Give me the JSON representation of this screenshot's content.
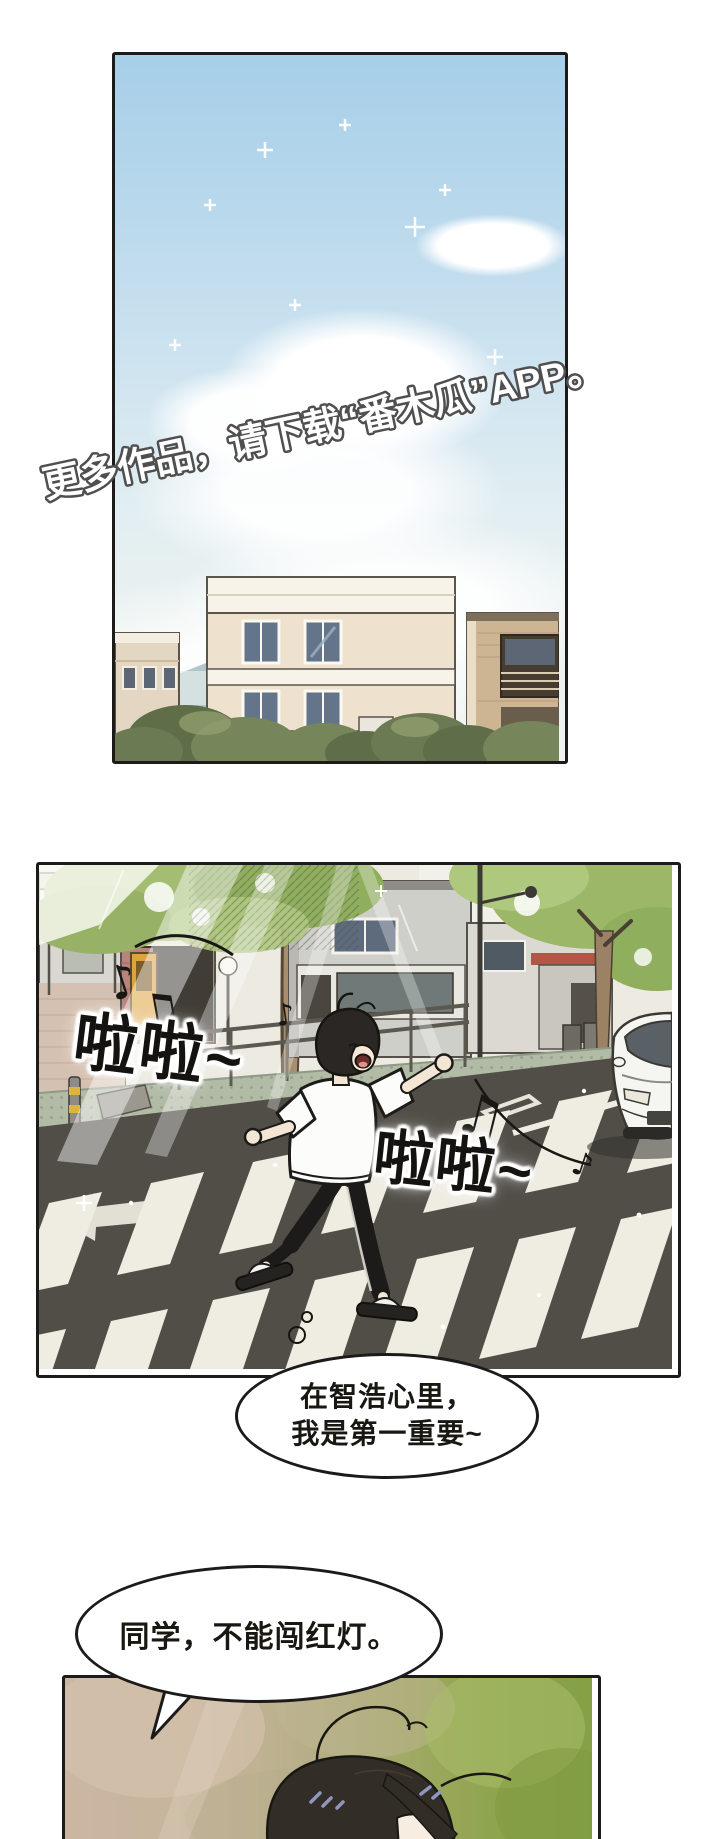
{
  "page": {
    "width": 720,
    "height": 1839,
    "background": "#ffffff"
  },
  "watermark": {
    "text": "更多作品，请下载“番木瓜”APP。"
  },
  "panel2": {
    "sfx_lala_left": "啦啦~",
    "sfx_lala_right": "啦啦~"
  },
  "bubbles": {
    "thought": {
      "line1": "在智浩心里，",
      "line2": "我是第一重要~"
    },
    "speech": {
      "text": "同学，不能闯红灯。"
    }
  },
  "icons": {
    "music_note": "♪",
    "music_note_double": "♫"
  },
  "colors": {
    "ink": "#1c1b19",
    "sky_top": "#a6cfe8",
    "road": "#514e48",
    "crosswalk_stripe": "#efece2",
    "sidewalk": "#b2bba6",
    "brick_shop": "#b9837c",
    "shop_door": "#dfa23f",
    "tree_foliage": "#9cb768",
    "car_body": "#f5f5f2",
    "hair": "#332d27",
    "skin": "#f3e6d4",
    "panel3_left": "#cbb6a2",
    "panel3_right": "#85a046"
  }
}
